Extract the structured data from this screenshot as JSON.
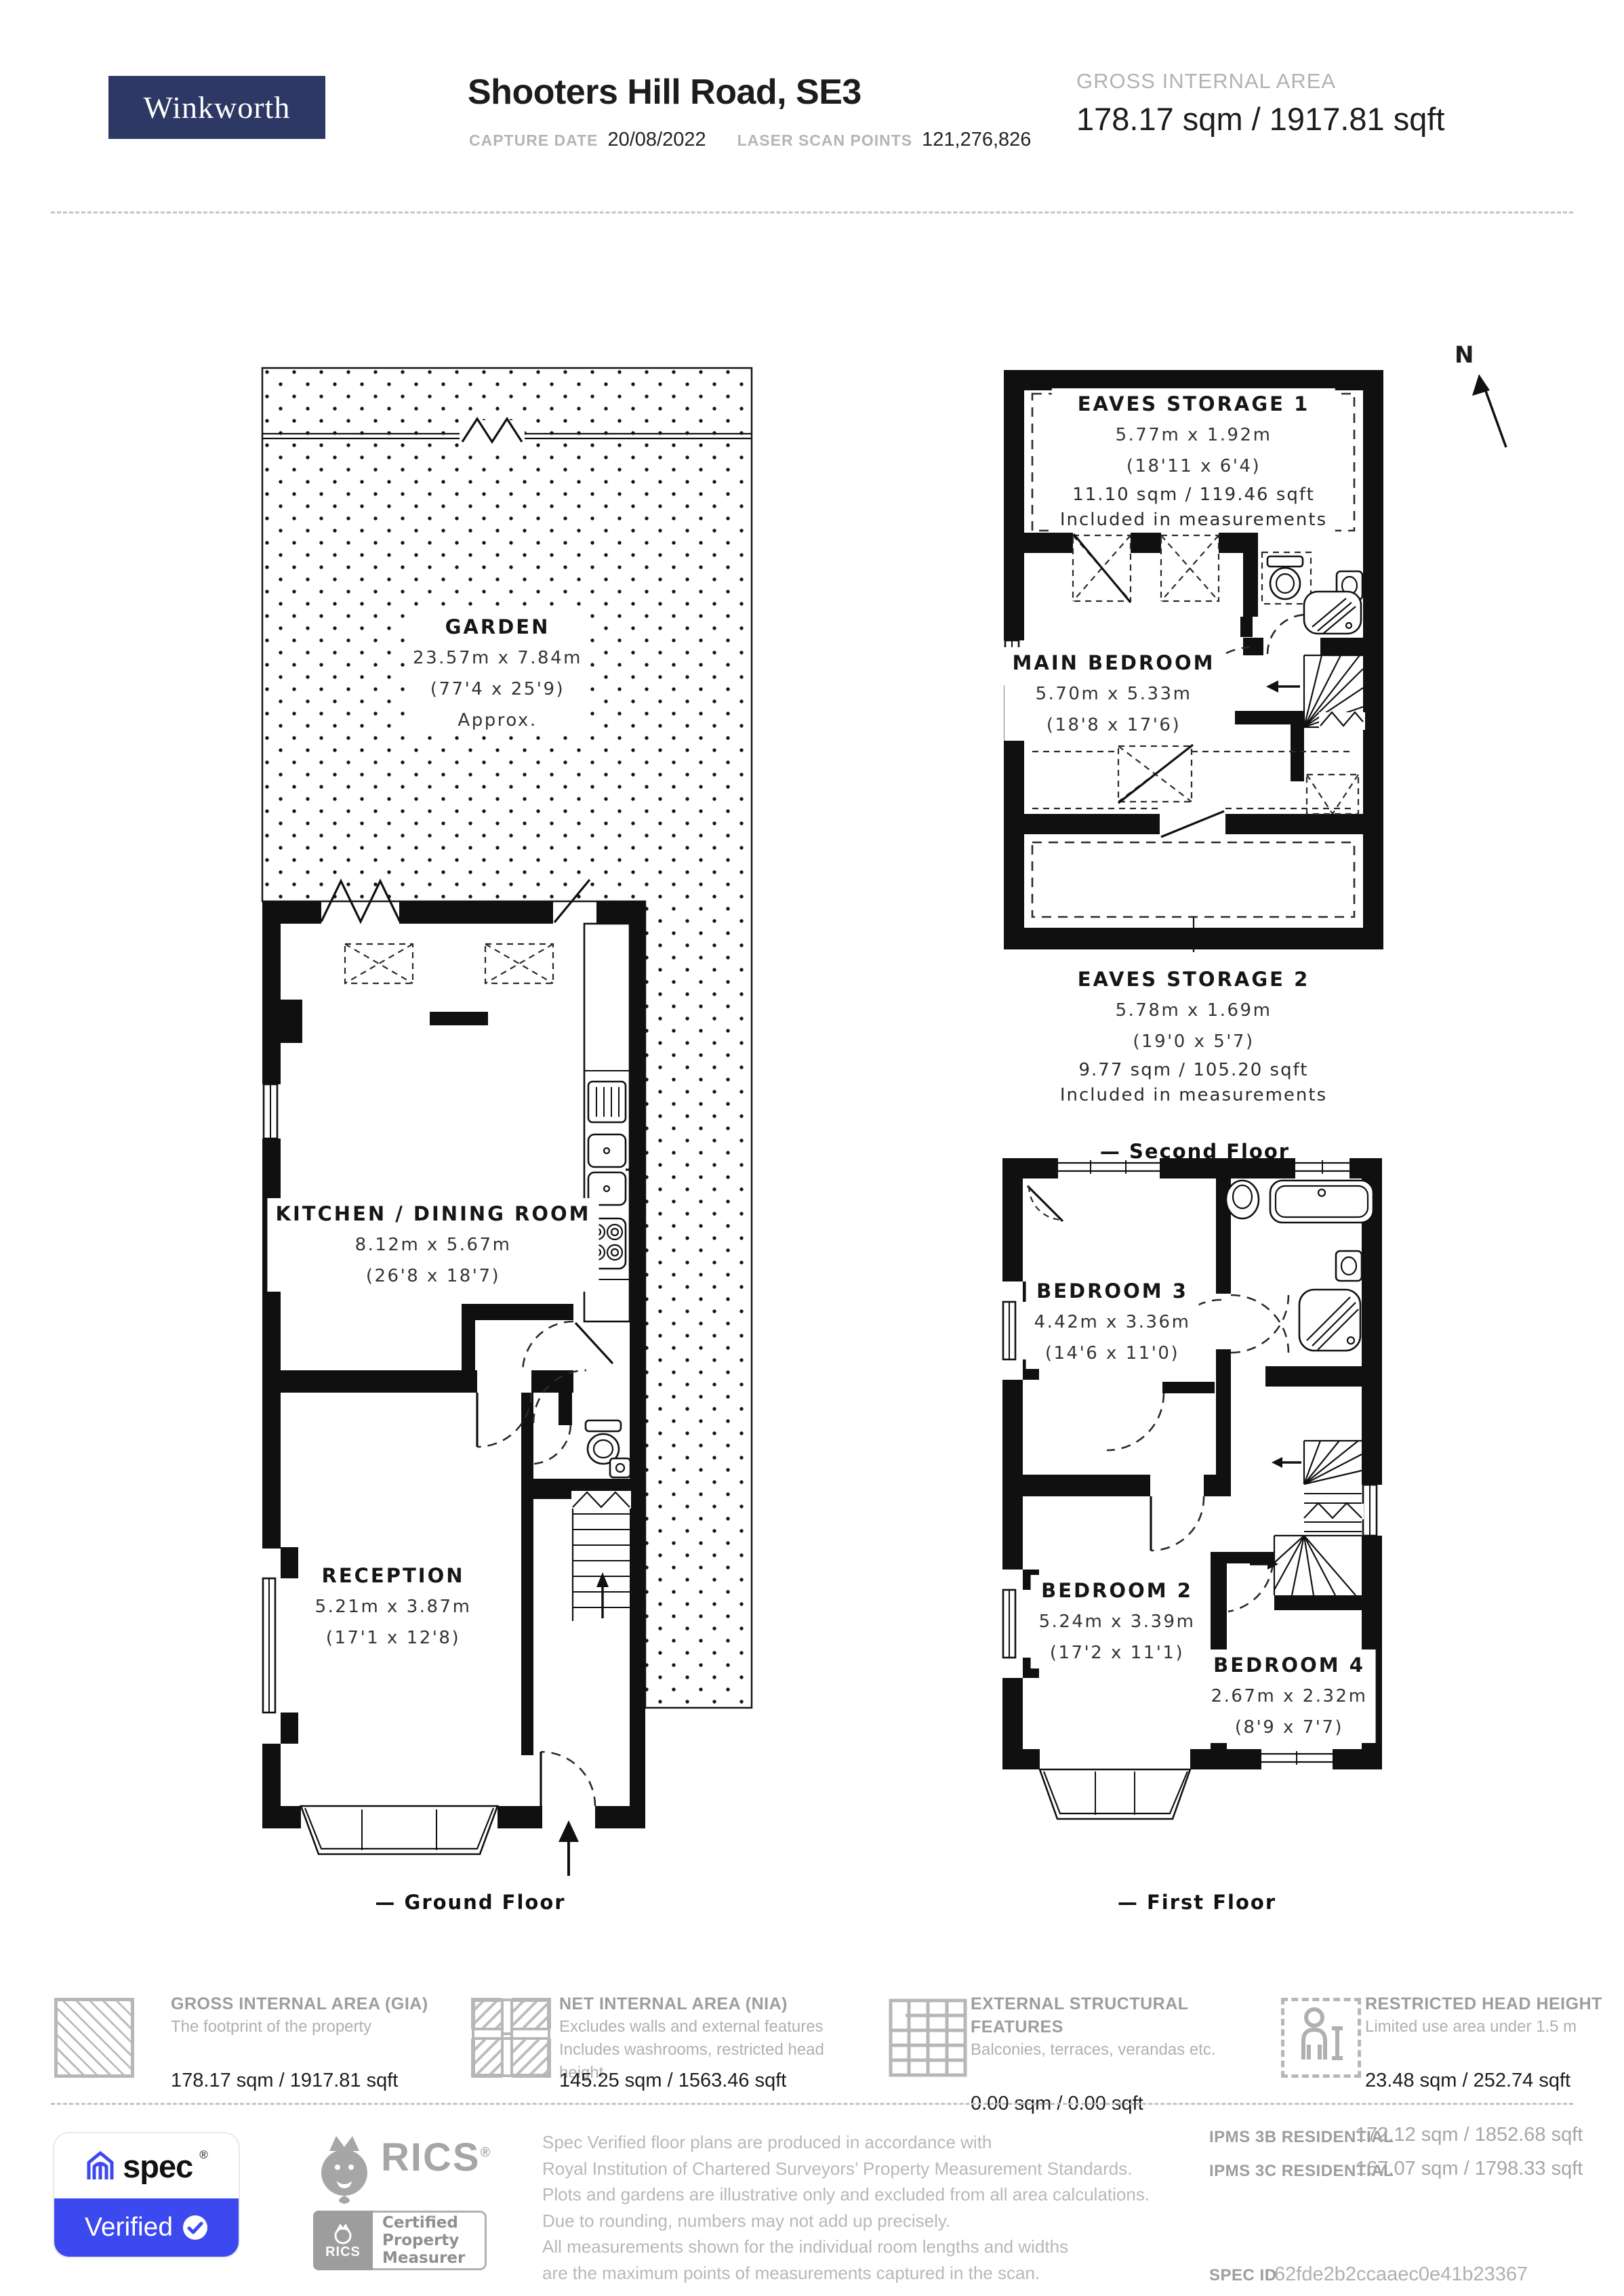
{
  "header": {
    "logo": "Winkworth",
    "title": "Shooters Hill Road, SE3",
    "capture_date_label": "CAPTURE DATE",
    "capture_date_value": "20/08/2022",
    "laser_scan_label": "LASER SCAN POINTS",
    "laser_scan_value": "121,276,826",
    "gia_label": "GROSS INTERNAL AREA",
    "gia_value": "178.17 sqm / 1917.81 sqft"
  },
  "compass": {
    "north": "N"
  },
  "plans": {
    "ground": {
      "label": "— Ground Floor",
      "garden": {
        "name": "GARDEN",
        "metric": "23.57m x 7.84m",
        "imperial": "(77'4 x 25'9)",
        "note": "Approx."
      },
      "kitchen": {
        "name": "KITCHEN / DINING ROOM",
        "metric": "8.12m x 5.67m",
        "imperial": "(26'8 x 18'7)"
      },
      "reception": {
        "name": "RECEPTION",
        "metric": "5.21m x 3.87m",
        "imperial": "(17'1 x 12'8)"
      }
    },
    "second": {
      "label": "— Second Floor",
      "eaves1": {
        "name": "EAVES STORAGE 1",
        "metric": "5.77m x 1.92m",
        "imperial": "(18'11 x 6'4)",
        "area": "11.10 sqm / 119.46 sqft",
        "note": "Included in measurements"
      },
      "main_bedroom": {
        "name": "MAIN BEDROOM",
        "metric": "5.70m x 5.33m",
        "imperial": "(18'8 x 17'6)"
      },
      "eaves2": {
        "name": "EAVES STORAGE 2",
        "metric": "5.78m x 1.69m",
        "imperial": "(19'0 x 5'7)",
        "area": "9.77 sqm / 105.20 sqft",
        "note": "Included in measurements"
      }
    },
    "first": {
      "label": "— First Floor",
      "bedroom3": {
        "name": "BEDROOM 3",
        "metric": "4.42m x 3.36m",
        "imperial": "(14'6 x 11'0)"
      },
      "bedroom2": {
        "name": "BEDROOM 2",
        "metric": "5.24m x 3.39m",
        "imperial": "(17'2 x 11'1)"
      },
      "bedroom4": {
        "name": "BEDROOM 4",
        "metric": "2.67m x 2.32m",
        "imperial": "(8'9 x 7'7)"
      }
    }
  },
  "legend": [
    {
      "title": "GROSS INTERNAL AREA (GIA)",
      "desc1": "The footprint of the property",
      "desc2": "",
      "value": "178.17 sqm / 1917.81 sqft"
    },
    {
      "title": "NET INTERNAL AREA (NIA)",
      "desc1": "Excludes walls and external features",
      "desc2": "Includes washrooms, restricted head height",
      "value": "145.25 sqm / 1563.46 sqft"
    },
    {
      "title": "EXTERNAL STRUCTURAL FEATURES",
      "desc1": "Balconies, terraces, verandas etc.",
      "desc2": "",
      "value": "0.00 sqm / 0.00 sqft"
    },
    {
      "title": "RESTRICTED HEAD HEIGHT",
      "desc1": "Limited use area under 1.5 m",
      "desc2": "",
      "value": "23.48 sqm / 252.74 sqft"
    }
  ],
  "footer": {
    "spec_brand": "spec",
    "spec_reg": "®",
    "spec_verified": "Verified",
    "rics_brand": "RICS",
    "rics_reg": "®",
    "rics_badge_brand": "RICS",
    "rics_badge_line1": "Certified",
    "rics_badge_line2": "Property",
    "rics_badge_line3": "Measurer",
    "disclaimer": [
      "Spec Verified floor plans are produced in accordance with",
      "Royal Institution of Chartered Surveyors’ Property Measurement Standards.",
      "Plots and gardens are illustrative only and excluded from all area calculations.",
      "Due to rounding, numbers may not add up precisely.",
      "All measurements shown for the individual room lengths and widths",
      "are the maximum points of measurements captured in the scan."
    ],
    "ipms": [
      {
        "label": "IPMS 3B RESIDENTIAL",
        "value": "172.12 sqm / 1852.68 sqft"
      },
      {
        "label": "IPMS 3C RESIDENTIAL",
        "value": "167.07 sqm / 1798.33 sqft"
      }
    ],
    "spec_id_label": "SPEC ID",
    "spec_id_value": "62fde2b2ccaaec0e41b23367"
  }
}
